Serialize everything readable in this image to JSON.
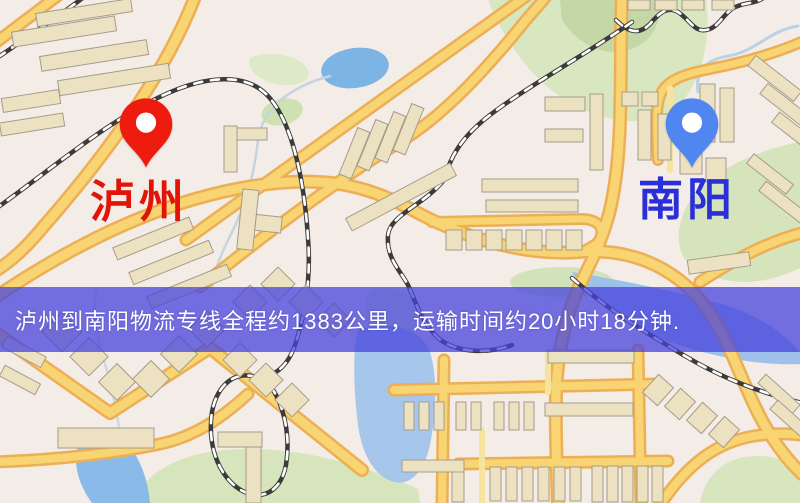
{
  "map": {
    "origin": {
      "label": "泸州",
      "pin_color": "#ee1c0f",
      "label_color": "#e11408"
    },
    "destination": {
      "label": "南阳",
      "pin_color": "#4f86f0",
      "label_color": "#2b2fd8"
    }
  },
  "banner": {
    "text": "泸州到南阳物流专线全程约1383公里，运输时间约20小时18分钟.",
    "background_color": "#4642dc",
    "text_color": "#ffffff",
    "distance_km": "1383",
    "duration": "20小时18分钟"
  }
}
